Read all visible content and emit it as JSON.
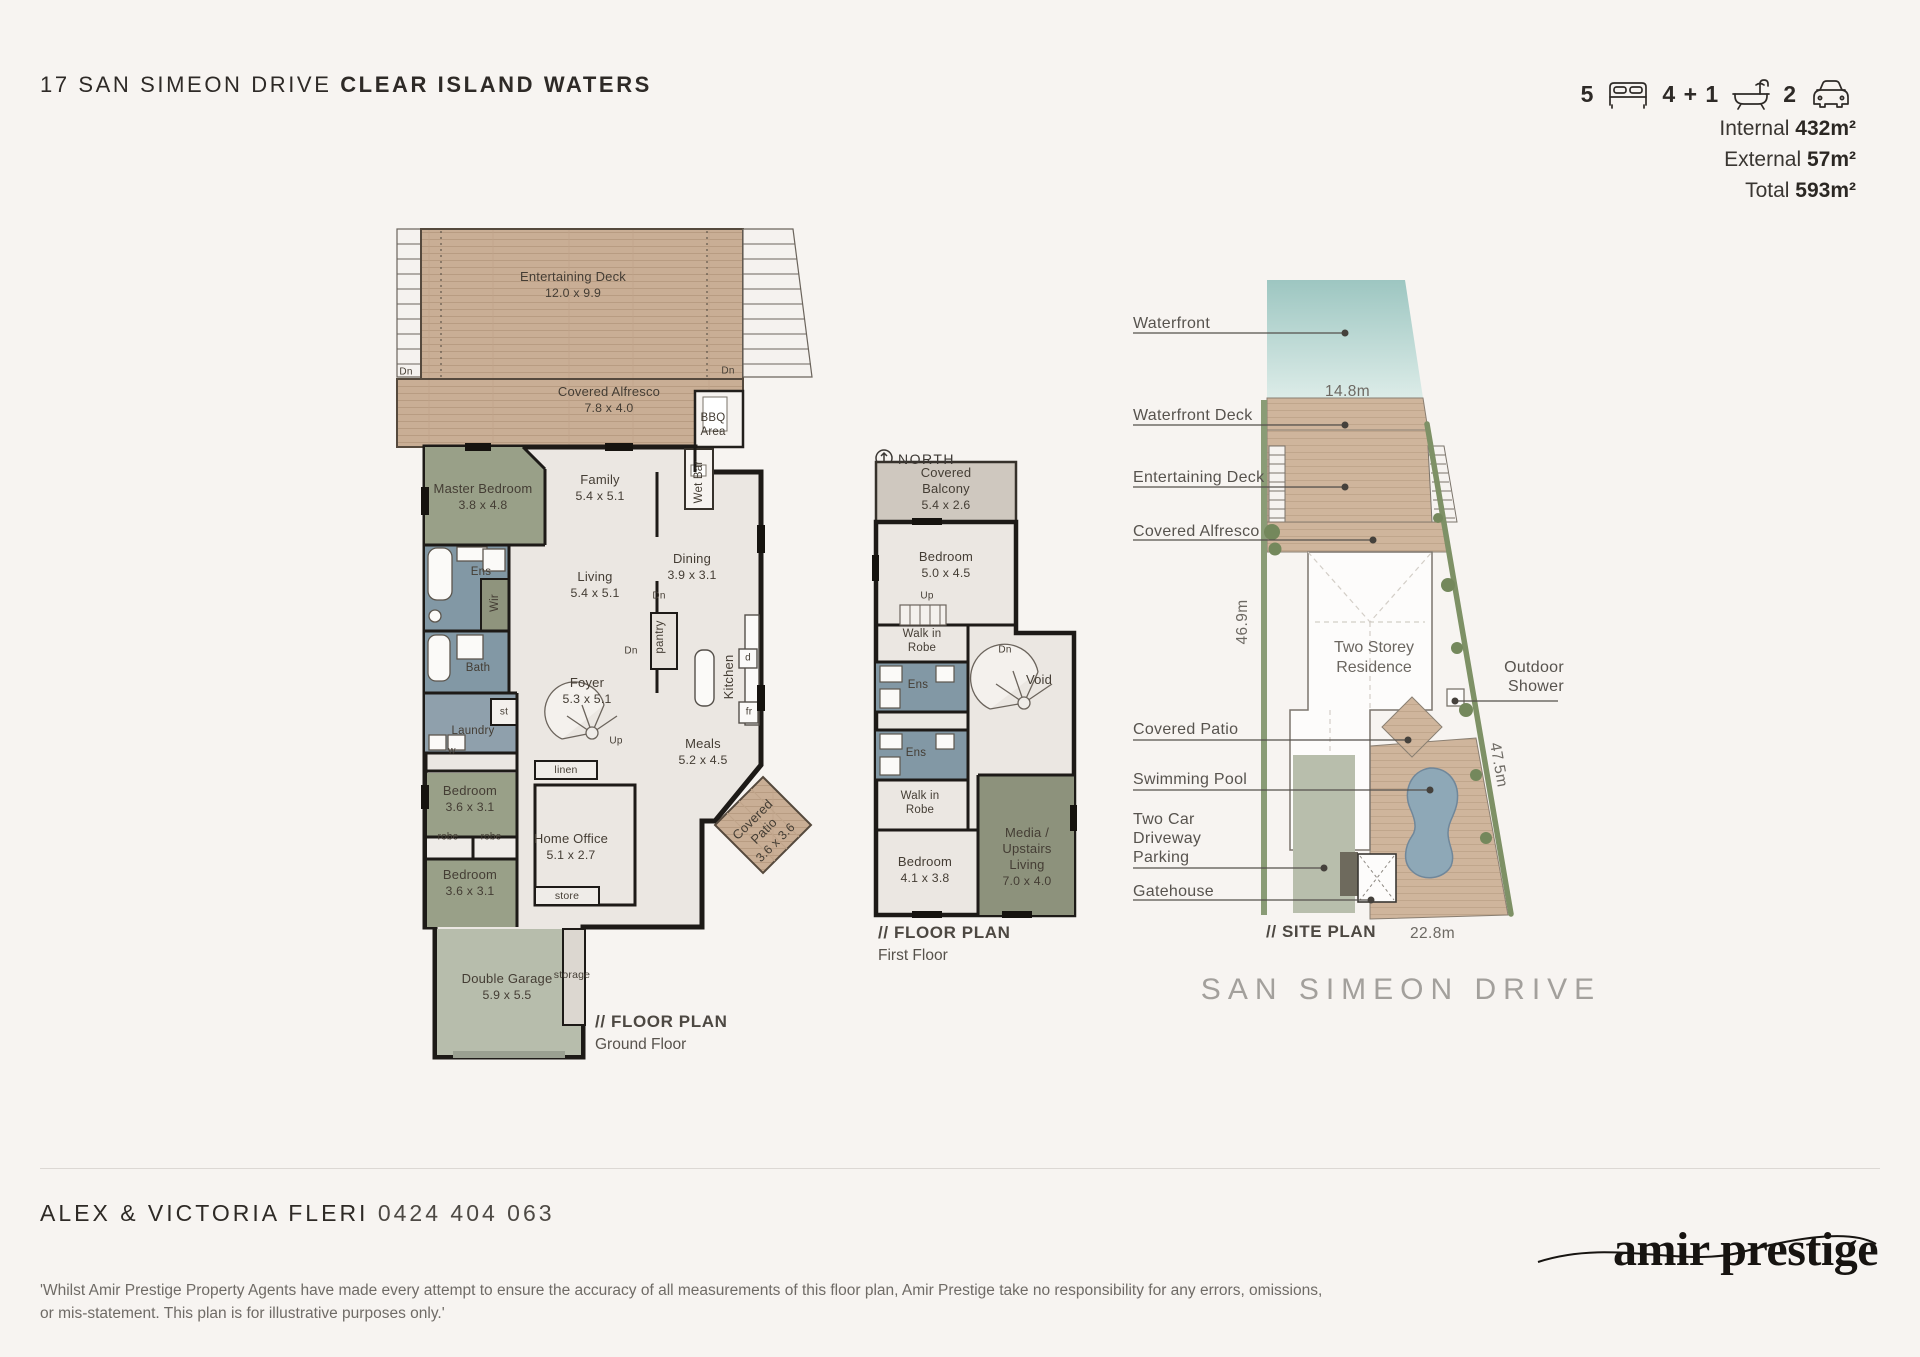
{
  "header": {
    "address_street": "17 SAN SIMEON DRIVE",
    "address_suburb": "CLEAR ISLAND WATERS",
    "stats": {
      "beds": "5",
      "baths": "4 + 1",
      "cars": "2"
    },
    "icons": {
      "beds": "bed-icon",
      "baths": "bath-icon",
      "cars": "car-icon",
      "north": "north-compass-icon"
    },
    "areas": [
      {
        "label": "Internal",
        "value": "432m²"
      },
      {
        "label": "External",
        "value": "57m²"
      },
      {
        "label": "Total",
        "value": "593m²"
      }
    ]
  },
  "ground_floor": {
    "plan_label": "// FLOOR PLAN",
    "plan_sublabel": "Ground Floor",
    "rooms": {
      "entertaining_deck": {
        "name": "Entertaining Deck",
        "dims": "12.0 x 9.9"
      },
      "covered_alfresco": {
        "name": "Covered Alfresco",
        "dims": "7.8 x 4.0"
      },
      "bbq": {
        "name": "BBQ Area"
      },
      "master_bedroom": {
        "name": "Master Bedroom",
        "dims": "3.8 x 4.8"
      },
      "family": {
        "name": "Family",
        "dims": "5.4 x 5.1"
      },
      "living": {
        "name": "Living",
        "dims": "5.4 x 5.1"
      },
      "dining": {
        "name": "Dining",
        "dims": "3.9 x 3.1"
      },
      "foyer": {
        "name": "Foyer",
        "dims": "5.3 x 5.1"
      },
      "meals": {
        "name": "Meals",
        "dims": "5.2 x 4.5"
      },
      "home_office": {
        "name": "Home Office",
        "dims": "5.1 x 2.7"
      },
      "bedroom_a": {
        "name": "Bedroom",
        "dims": "3.6 x 3.1"
      },
      "bedroom_b": {
        "name": "Bedroom",
        "dims": "3.6 x 3.1"
      },
      "double_garage": {
        "name": "Double Garage",
        "dims": "5.9 x 5.5"
      },
      "covered_patio": {
        "name": "Covered Patio",
        "dims": "3.6 x 3.6"
      },
      "ens": {
        "name": "Ens"
      },
      "bath": {
        "name": "Bath"
      },
      "laundry": {
        "name": "Laundry"
      },
      "wir": {
        "name": "Wir"
      },
      "wet_bar": {
        "name": "Wet Bar"
      },
      "kitchen": {
        "name": "Kitchen"
      },
      "pantry": {
        "name": "pantry"
      }
    },
    "tags": {
      "dn": "Dn",
      "up": "Up",
      "robe": "robe",
      "linen": "linen",
      "store": "store",
      "storage": "storage",
      "st": "st",
      "w": "w",
      "d": "d",
      "fr": "fr"
    }
  },
  "first_floor": {
    "plan_label": "// FLOOR PLAN",
    "plan_sublabel": "First Floor",
    "north_label": "NORTH",
    "rooms": {
      "covered_balcony": {
        "name": "Covered Balcony",
        "dims": "5.4 x 2.6"
      },
      "bedroom_front": {
        "name": "Bedroom",
        "dims": "5.0 x 4.5"
      },
      "walk_in_robe_a": {
        "name": "Walk in Robe"
      },
      "ens_a": {
        "name": "Ens"
      },
      "void": {
        "name": "Void"
      },
      "ens_b": {
        "name": "Ens"
      },
      "walk_in_robe_b": {
        "name": "Walk in Robe"
      },
      "bedroom_rear": {
        "name": "Bedroom",
        "dims": "4.1 x 3.8"
      },
      "media": {
        "name": "Media / Upstairs Living",
        "dims": "7.0 x 4.0"
      }
    },
    "tags": {
      "dn": "Dn",
      "up": "Up"
    }
  },
  "site_plan": {
    "plan_label": "// SITE PLAN",
    "street": "SAN SIMEON DRIVE",
    "residence": "Two Storey Residence",
    "dims": {
      "water": "14.8m",
      "side_left": "46.9m",
      "side_right": "47.5m",
      "front": "22.8m"
    },
    "callouts": {
      "waterfront": "Waterfront",
      "waterfront_deck": "Waterfront Deck",
      "entertaining_deck": "Entertaining Deck",
      "covered_alfresco": "Covered Alfresco",
      "covered_patio": "Covered Patio",
      "swimming_pool": "Swimming Pool",
      "driveway": "Two Car Driveway Parking",
      "gatehouse": "Gatehouse",
      "outdoor_shower": "Outdoor Shower"
    }
  },
  "footer": {
    "agent": "ALEX & VICTORIA FLERI",
    "phone": "0424 404 063",
    "logo": "amir prestige",
    "disclaimer": "'Whilst Amir Prestige Property Agents have made every attempt to ensure the accuracy of all measurements of this floor plan, Amir Prestige take no responsibility for any errors, omissions, or mis-statement. This plan is for illustrative purposes only.'"
  }
}
